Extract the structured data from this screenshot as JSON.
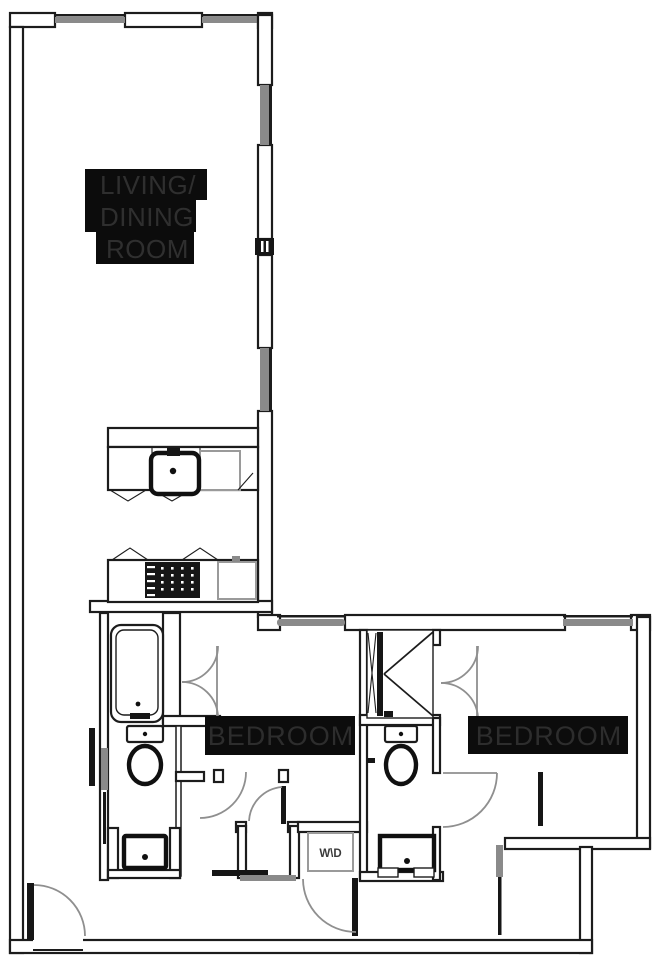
{
  "title": "Two-bedroom apartment floor plan",
  "labels": {
    "living_dining_line1": "LIVING/",
    "living_dining_line2": "DINING",
    "living_dining_line3": "ROOM",
    "bedroom_1": "BEDROOM",
    "bedroom_2": "BEDROOM",
    "washer_dryer": "W\\D"
  },
  "colors": {
    "wall_line": "#1c1c1c",
    "window_gray": "#8a8a8a",
    "door_arc_gray": "#8f8f8f",
    "label_background": "#0c0c0c",
    "label_text": "#2f2f2f",
    "background": "#ffffff"
  }
}
